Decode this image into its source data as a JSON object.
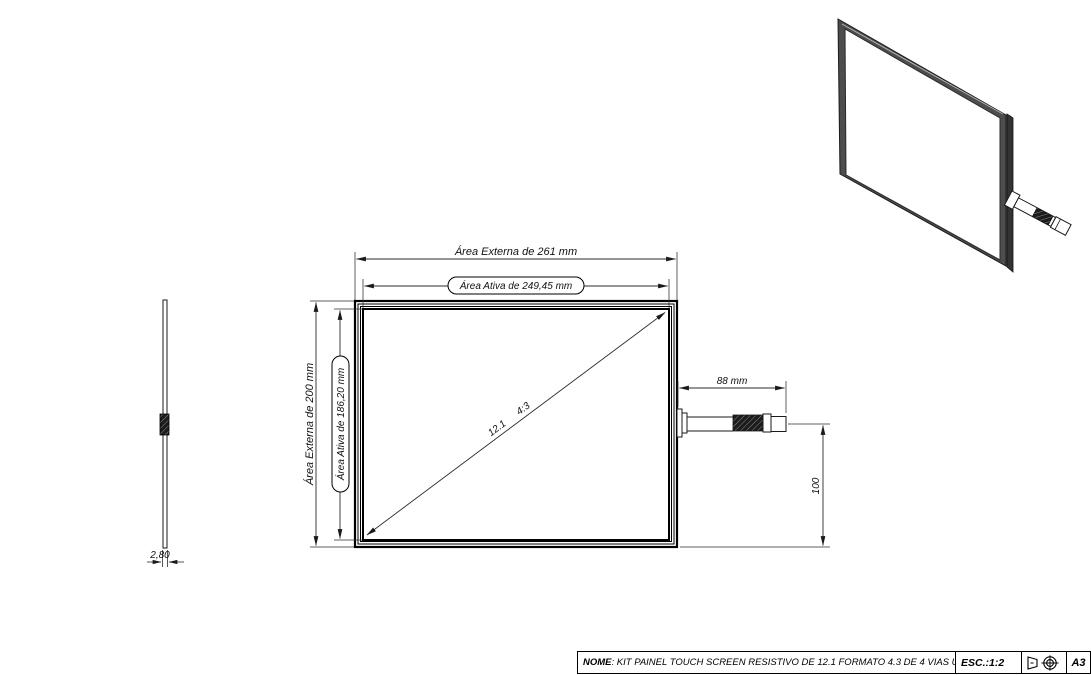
{
  "drawing": {
    "bg_color": "#ffffff",
    "line_color": "#1a1a1a",
    "frame_fill": "#4d4d4d"
  },
  "dimensions": {
    "outer_width": "Área Externa de 261 mm",
    "active_width": "Área Ativa de 249,45 mm",
    "outer_height": "Área Externa de 200 mm",
    "active_height": "Área Ativa de 186,20 mm",
    "diagonal_inches": "12.1",
    "aspect_ratio": "4:3",
    "cable_length": "88 mm",
    "cable_offset": "100",
    "thickness": "2,80"
  },
  "title_block": {
    "name_label": "NOME",
    "name_value": ": KIT PAINEL TOUCH SCREEN RESISTIVO DE 12.1 FORMATO 4.3 DE 4 VIAS USB",
    "scale_label": "ESC.:1:2",
    "sheet_size": "A3",
    "projection_icon": "first-angle-projection-icon"
  }
}
